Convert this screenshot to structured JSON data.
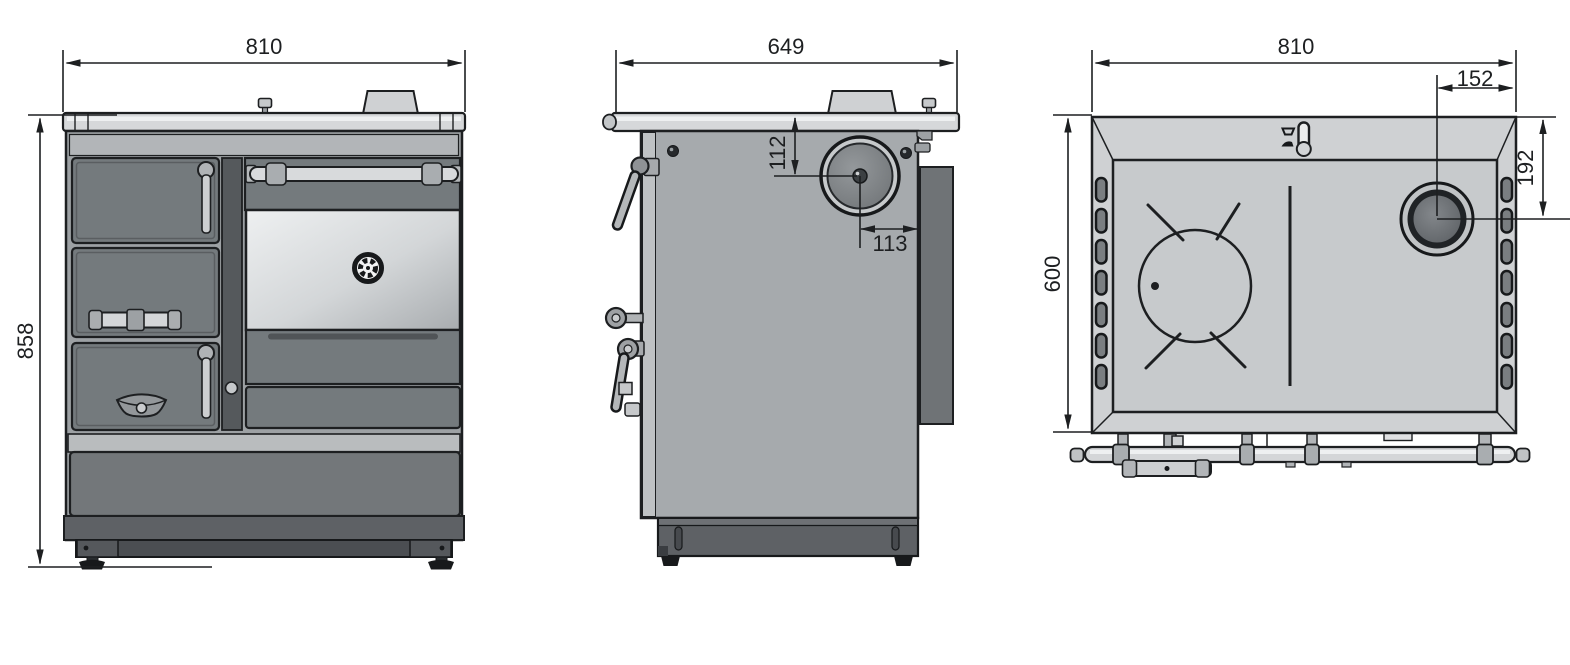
{
  "drawing": {
    "kind": "three-view dimensional drawing of a wood-burning cooker stove",
    "background": "#ffffff"
  },
  "views": {
    "front": {
      "width": "810",
      "height": "858"
    },
    "side": {
      "depth": "649",
      "flue_center_from_top": "112",
      "flue_center_from_back": "113"
    },
    "top": {
      "width": "810",
      "flue_center_from_right": "152",
      "flue_center_from_back": "192",
      "depth": "600"
    }
  },
  "icons": {
    "flue_outlet": "round-flue-pipe-outlet",
    "cooking_plate": "round-hotplate-with-trivet-lines",
    "oven_thermometer": "round-gauge",
    "damper_control": "slide-lever-with-position-glyphs",
    "adjustable_foot": "levelling-foot"
  },
  "colors": {
    "line": "#1d1f21",
    "surface_light": "#d6d8da",
    "body_side": "#a6aaad",
    "door_panel": "#747a7d",
    "cooktop_top": "#cbced0",
    "drawer_front": "#73777a",
    "plinth": "#5e6165",
    "base_frame": "#4b4e52",
    "back_heat_shield": "#6f7376",
    "glass_highlight": "#eef0f1",
    "glass_shadow": "#a8acaf",
    "background": "#ffffff"
  }
}
